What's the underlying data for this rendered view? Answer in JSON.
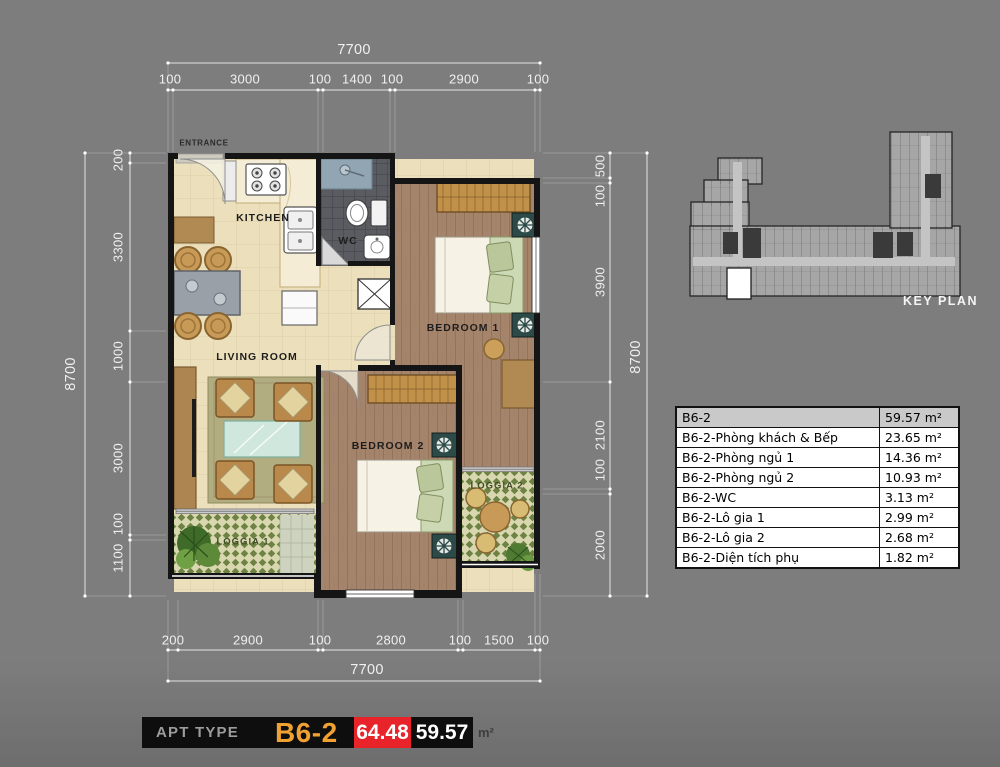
{
  "plan": {
    "entrance_label": "ENTRANCE",
    "room_labels": {
      "kitchen": "KITCHEN",
      "wc": "WC",
      "living_room": "LIVING ROOM",
      "bedroom_1": "BEDROOM 1",
      "bedroom_2": "BEDROOM 2",
      "loggia_1": "LOGGIA 1",
      "loggia_2": "LOGGIA 2"
    }
  },
  "dimensions": {
    "top": {
      "total": "7700",
      "segments": [
        "100",
        "3000",
        "100",
        "1400",
        "100",
        "2900",
        "100"
      ]
    },
    "bottom": {
      "total": "7700",
      "segments": [
        "200",
        "2900",
        "100",
        "2800",
        "100",
        "1500",
        "100"
      ]
    },
    "left": {
      "total": "8700",
      "segments": [
        "200",
        "3300",
        "1000",
        "3000",
        "100",
        "1100"
      ]
    },
    "right": {
      "total": "8700",
      "segments": [
        "500",
        "100",
        "3900",
        "2100",
        "100",
        "2000"
      ]
    }
  },
  "key_plan": {
    "caption": "KEY PLAN"
  },
  "area_table": {
    "header": {
      "label": "B6-2",
      "value": "59.57 m²"
    },
    "rows": [
      {
        "label": "B6-2-Phòng khách & Bếp",
        "value": "23.65 m²"
      },
      {
        "label": "B6-2-Phòng ngủ 1",
        "value": "14.36 m²"
      },
      {
        "label": "B6-2-Phòng ngủ 2",
        "value": "10.93 m²"
      },
      {
        "label": "B6-2-WC",
        "value": "3.13 m²"
      },
      {
        "label": "B6-2-Lô gia 1",
        "value": "2.99 m²"
      },
      {
        "label": "B6-2-Lô gia 2",
        "value": "2.68 m²"
      },
      {
        "label": "B6-2-Diện tích phụ",
        "value": "1.82 m²"
      }
    ]
  },
  "footer": {
    "apt_type_label": "APT TYPE",
    "apt_code": "B6-2",
    "area_gross": "64.48",
    "area_net": "59.57",
    "area_unit": "m²"
  },
  "colors": {
    "background": "#7b7b7b",
    "apt_code_orange": "#f0a132",
    "highlight_red": "#e8242a",
    "bar_black": "#0e0e0e"
  }
}
